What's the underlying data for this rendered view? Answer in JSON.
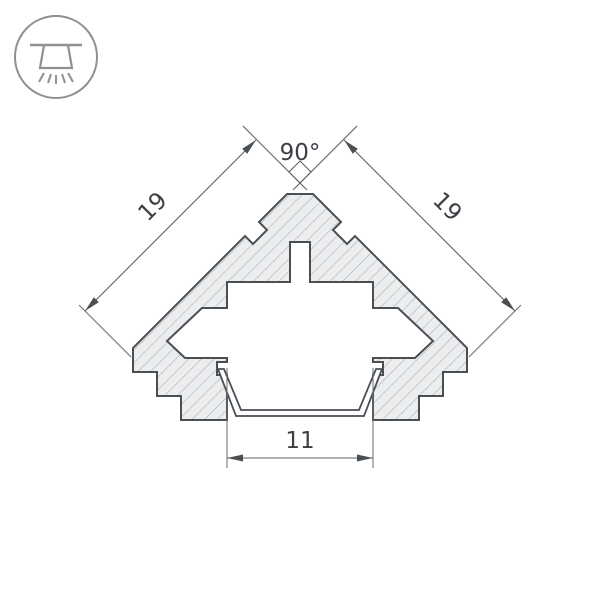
{
  "page": {
    "background": "#ffffff",
    "description": "Technical cross-section drawing of a 45-degree corner LED profile"
  },
  "icon": {
    "name": "ceiling-light-icon"
  },
  "drawing": {
    "type": "technical-drawing",
    "dimensions": {
      "angle_top": "90°",
      "side_left": "19",
      "side_right": "19",
      "bottom_width": "11"
    },
    "colors": {
      "outline": "#4a4f54",
      "dimension": "#5d6165",
      "hatch": "#a3a7aa",
      "material_fill": "#ecedee",
      "text": "#3b4046"
    }
  }
}
